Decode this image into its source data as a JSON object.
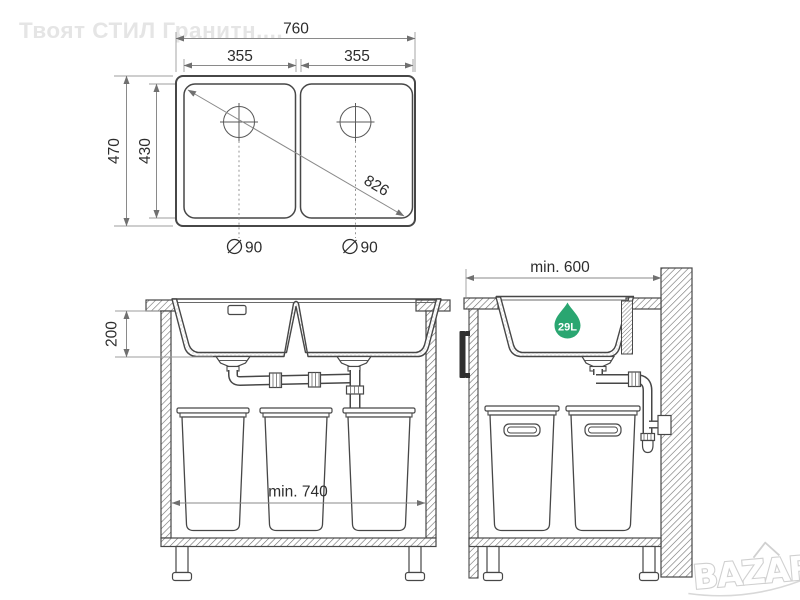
{
  "watermark": {
    "brand_text": "Твоят СТИЛ Гранитн....",
    "logo_text": "BAZAR"
  },
  "colors": {
    "drawing_line": "#474747",
    "dimension_line": "#8a8a8a",
    "dimension_text": "#2d2d2d",
    "hatch_gray": "#6e6e6e",
    "capacity_green": "#2aa671",
    "watermark_gray": "#e5e5e5"
  },
  "plan_view": {
    "dim_total_width": "760",
    "dim_bowl_width_left": "355",
    "dim_bowl_width_right": "355",
    "dim_total_depth": "470",
    "dim_bowl_depth": "430",
    "dim_diagonal": "826",
    "dim_drain_diameter_left": "90",
    "dim_drain_diameter_right": "90"
  },
  "front_section": {
    "dim_bowl_height": "200",
    "dim_min_cabinet_width": "min. 740"
  },
  "side_section": {
    "dim_min_cabinet_depth": "min. 600",
    "capacity_label": "29L"
  }
}
